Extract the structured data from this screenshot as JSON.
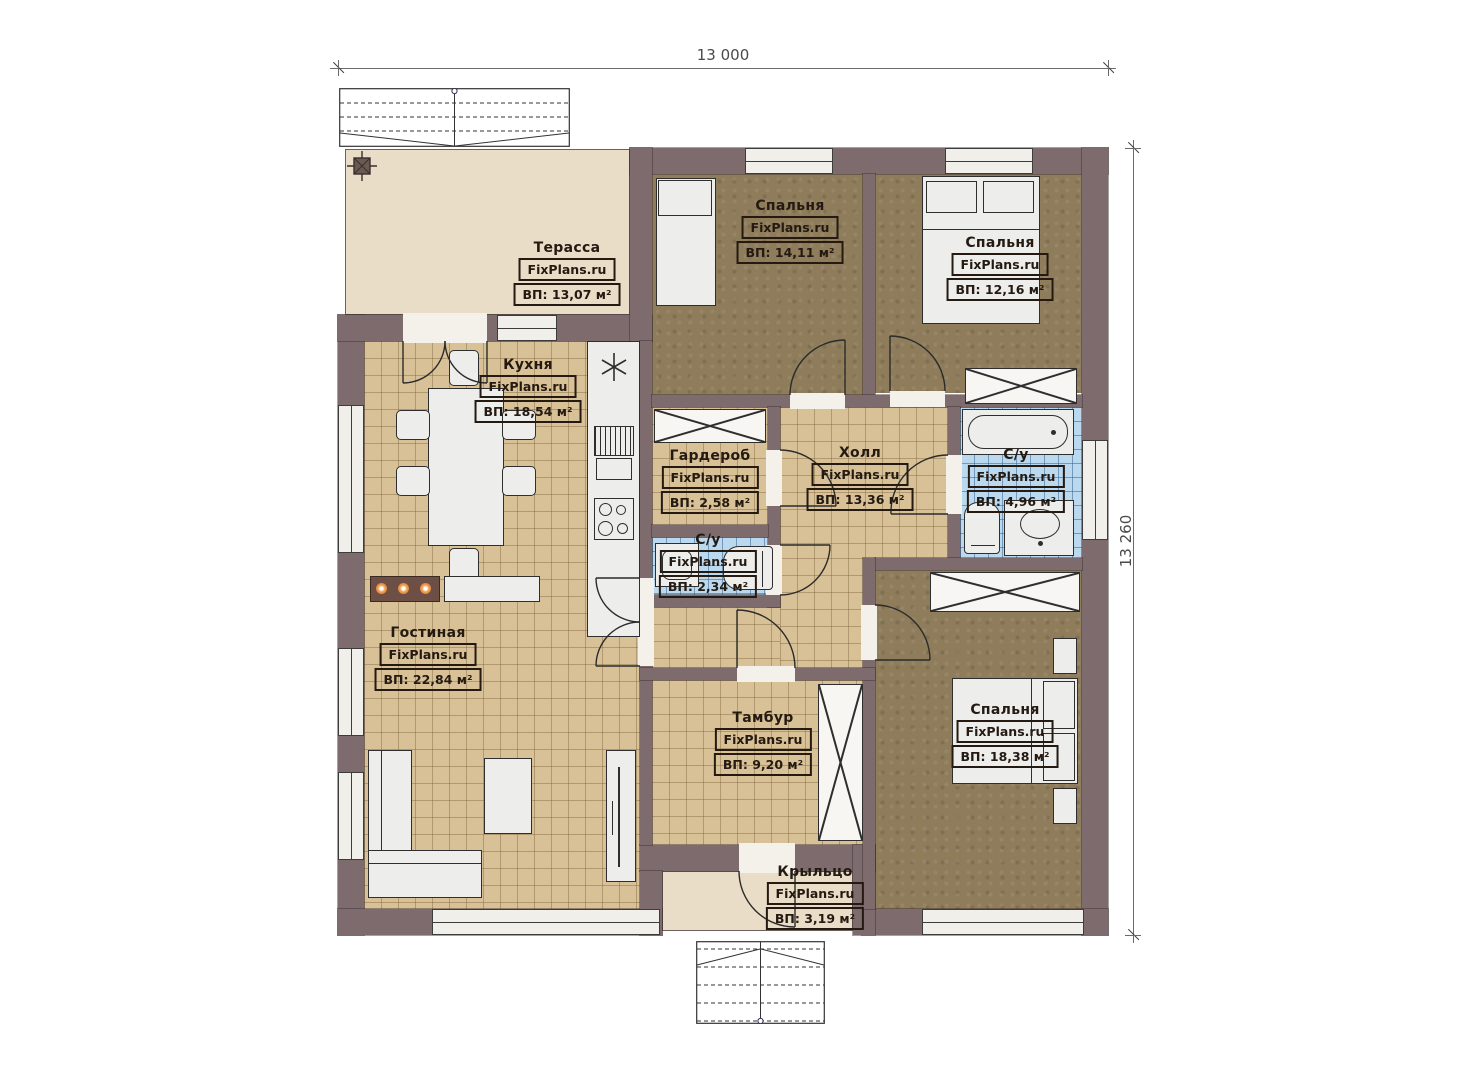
{
  "watermark": "FixPlans.ru",
  "dimensions": {
    "width": "13 000",
    "height": "13 260"
  },
  "rooms": [
    {
      "key": "terrace",
      "name": "Терасса",
      "area": "ВП: 13,07 м²"
    },
    {
      "key": "kitchen",
      "name": "Кухня",
      "area": "ВП: 18,54 м²"
    },
    {
      "key": "bedroom-top",
      "name": "Спальня",
      "area": "ВП: 14,11 м²"
    },
    {
      "key": "bedroom-right",
      "name": "Спальня",
      "area": "ВП: 12,16 м²"
    },
    {
      "key": "wardrobe-room",
      "name": "Гардероб",
      "area": "ВП: 2,58 м²"
    },
    {
      "key": "hall",
      "name": "Холл",
      "area": "ВП: 13,36 м²"
    },
    {
      "key": "bathroom-main",
      "name": "С/у",
      "area": "ВП: 4,96 м²"
    },
    {
      "key": "bathroom-small",
      "name": "С/у",
      "area": "ВП: 2,34 м²"
    },
    {
      "key": "living-room",
      "name": "Гостиная",
      "area": "ВП: 22,84 м²"
    },
    {
      "key": "vestibule",
      "name": "Тамбур",
      "area": "ВП: 9,20 м²"
    },
    {
      "key": "bedroom-master",
      "name": "Спальня",
      "area": "ВП: 18,38 м²"
    },
    {
      "key": "porch",
      "name": "Крыльцо",
      "area": "ВП: 3,19 м²"
    }
  ],
  "colors": {
    "wall": "#7d6b6e",
    "tile_floor": "#d8c197",
    "carpet_floor": "#8e7c5b",
    "bath_floor": "#bad9ef",
    "terrace_floor": "#e9ddc7",
    "dimension_text": "#4a4a4a",
    "label_text": "#241a12"
  }
}
